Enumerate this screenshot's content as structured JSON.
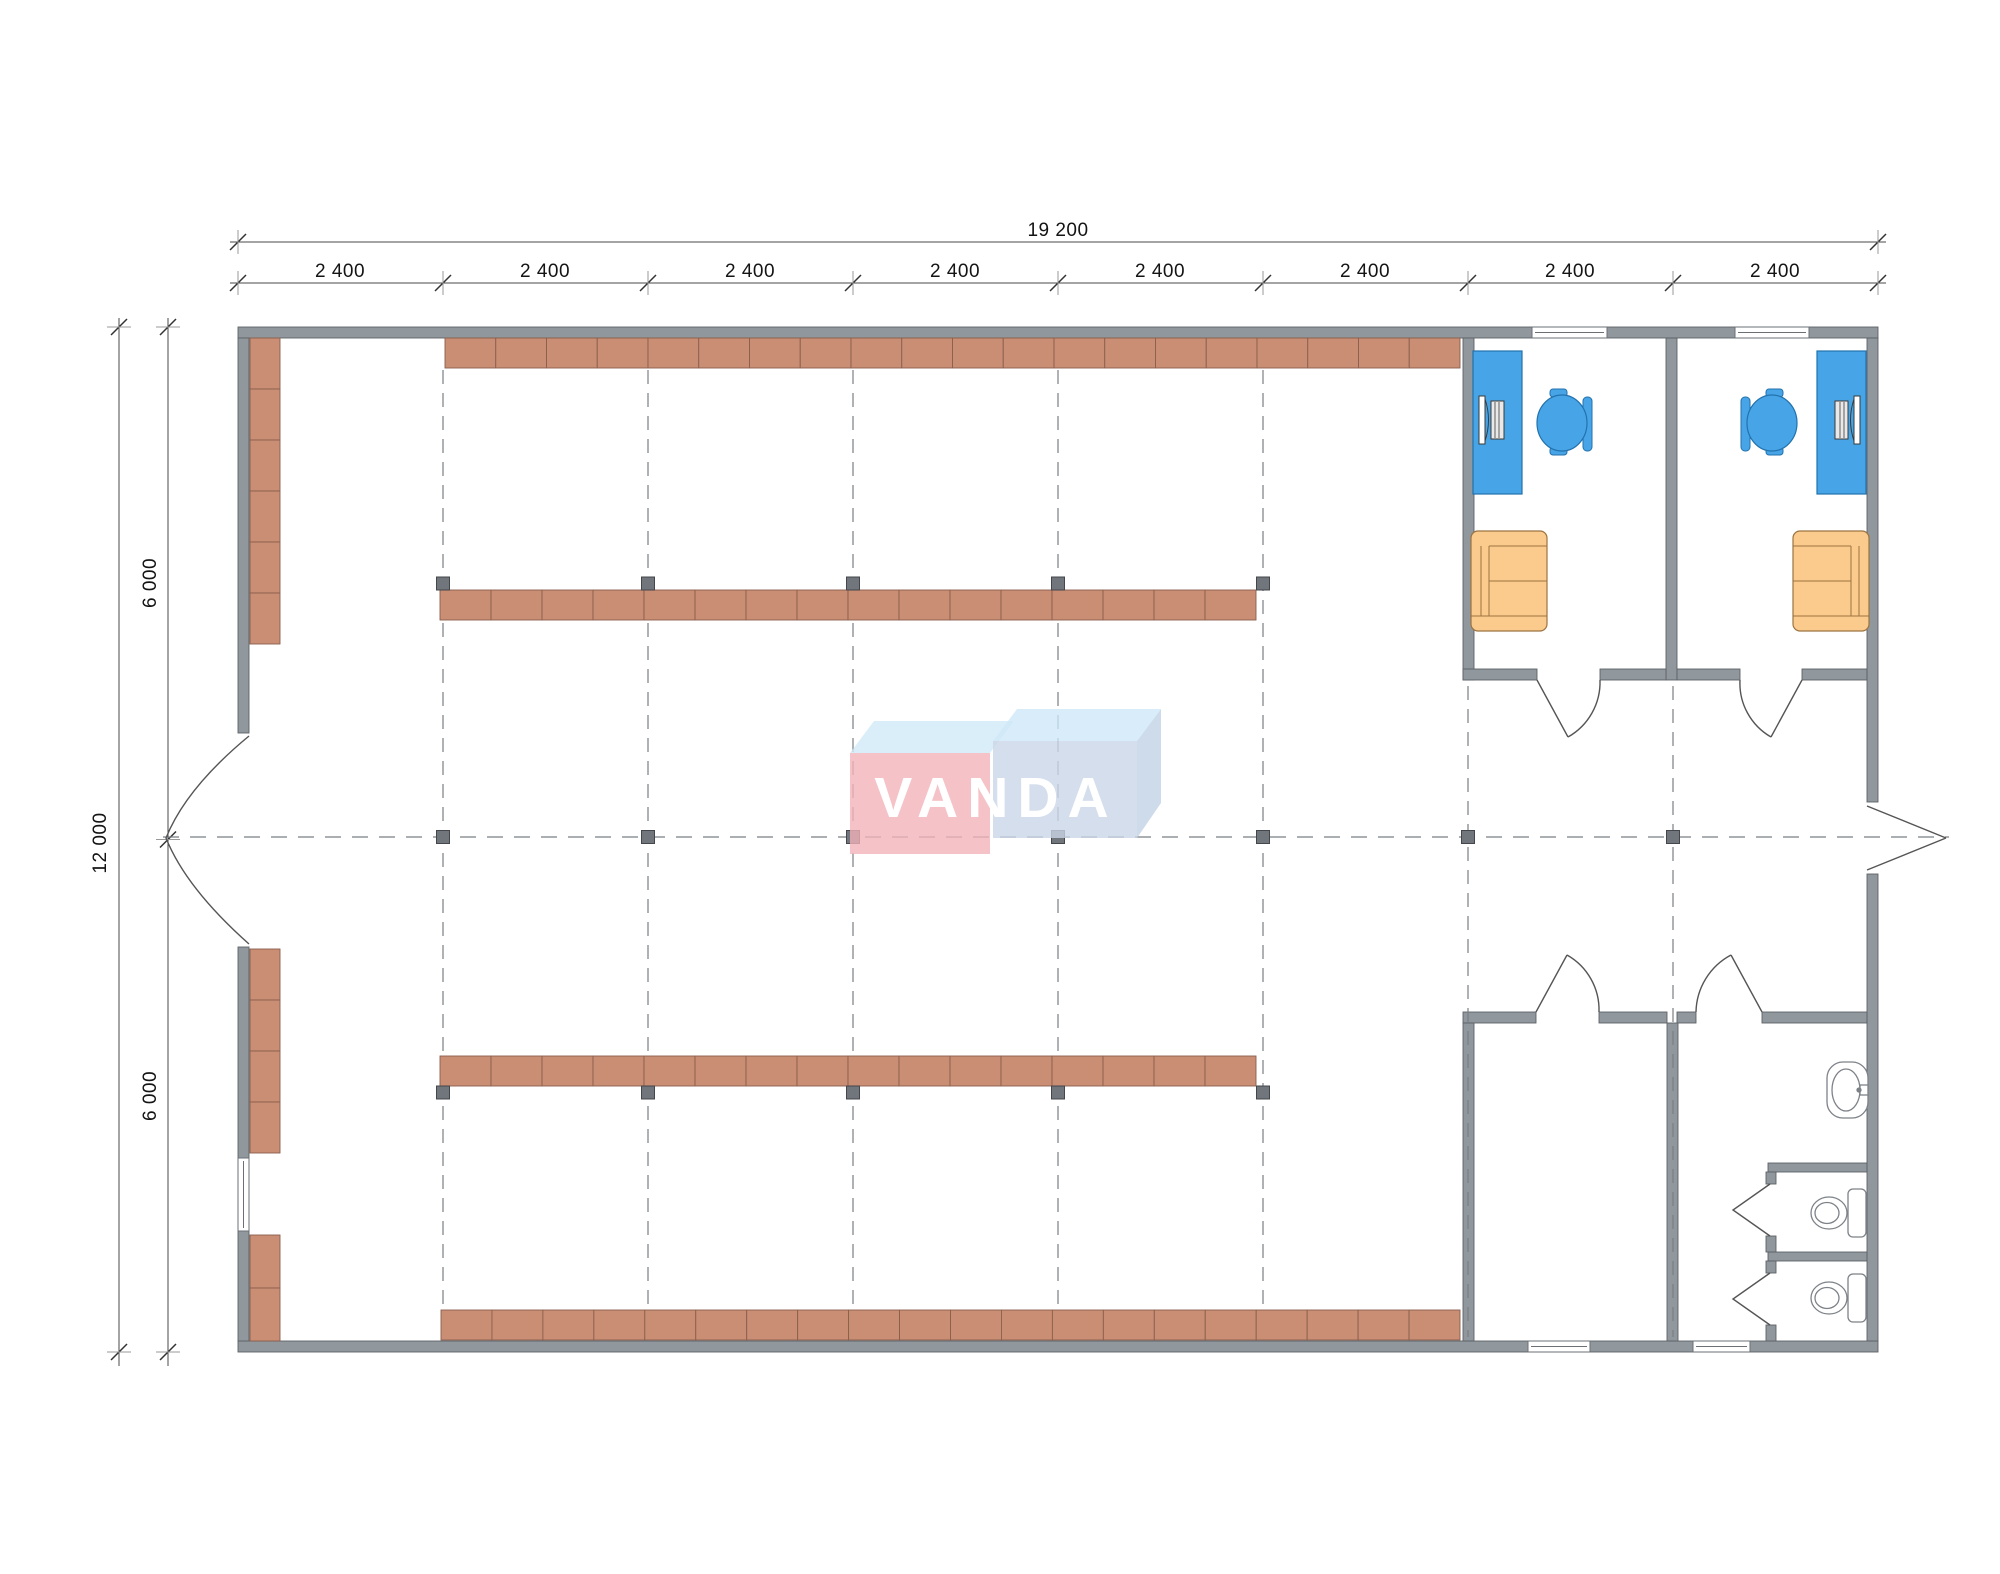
{
  "drawing": {
    "type": "floor-plan",
    "watermark": "VANDA"
  },
  "dimensions": {
    "total_width": "19 200",
    "bay_labels": [
      "2 400",
      "2 400",
      "2 400",
      "2 400",
      "2 400",
      "2 400",
      "2 400",
      "2 400"
    ],
    "total_height": "12 000",
    "half_height_top": "6 000",
    "half_height_bottom": "6 000"
  },
  "logo": {
    "text": "VANDA"
  },
  "colors": {
    "wall": "#90979d",
    "wall_outline": "#5d6267",
    "shelf": "#c98e73",
    "shelf_outline": "#8a5f4d",
    "desk_blue": "#47a5e7",
    "sofa_orange": "#fbcb8e",
    "marker_gray": "#70767c",
    "grid_gray": "#7a7f84",
    "logo_pink": "#f1b2b8",
    "logo_top_blue": "#cfe9f8",
    "logo_front_blue": "#c9d5e6"
  }
}
